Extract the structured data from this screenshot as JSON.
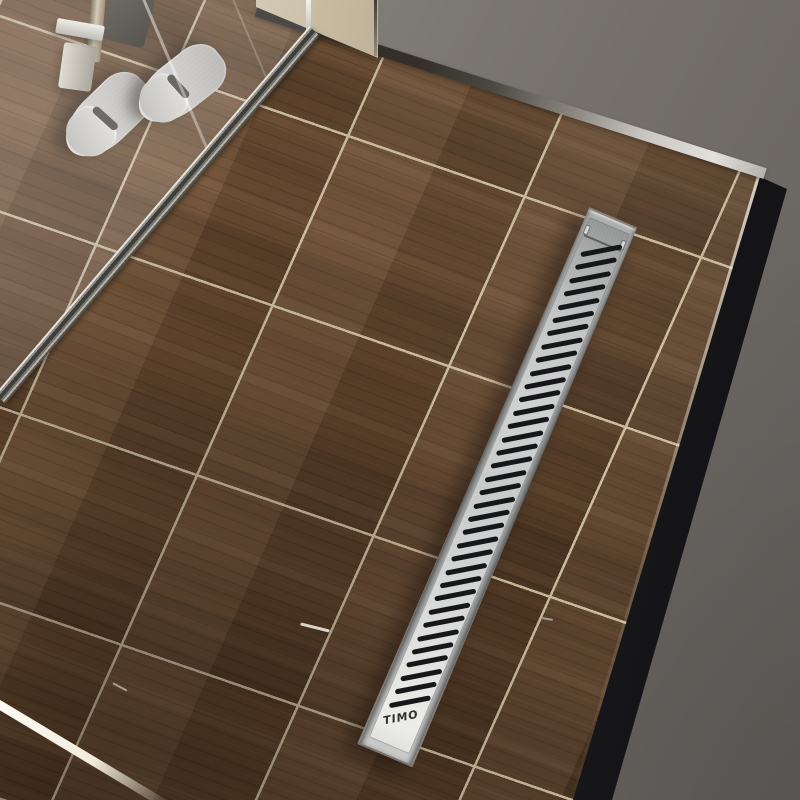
{
  "scene": {
    "subject": "3D render of a stainless linear shower drain installed in a dark wood-look tile bathroom floor",
    "objects": {
      "drain": "linear shower drain with slotted grate",
      "slippers": "pair of gray hotel slippers",
      "glass": "frameless glass shower screen with clamp hardware",
      "floor": "dark walnut wood-look porcelain tile platform with black side panel"
    }
  },
  "drain": {
    "logo_text": "TIMO",
    "slot_count": 35
  },
  "slippers": {
    "count": 2
  },
  "theme": {
    "floor-base": "#5e422b",
    "grout": "#cbbb9e",
    "trim-silver": "#e2e0db",
    "beige-wall": "#cfc3aa",
    "steel-light": "#ecedeb",
    "steel-dark": "#939594",
    "slot-color": "#17171a",
    "logo-color": "#2e2e2e",
    "slipper": "#c9c7c3",
    "track-dark": "#3f3e3b",
    "glass-tint": "rgba(210,216,222,0.12)"
  }
}
